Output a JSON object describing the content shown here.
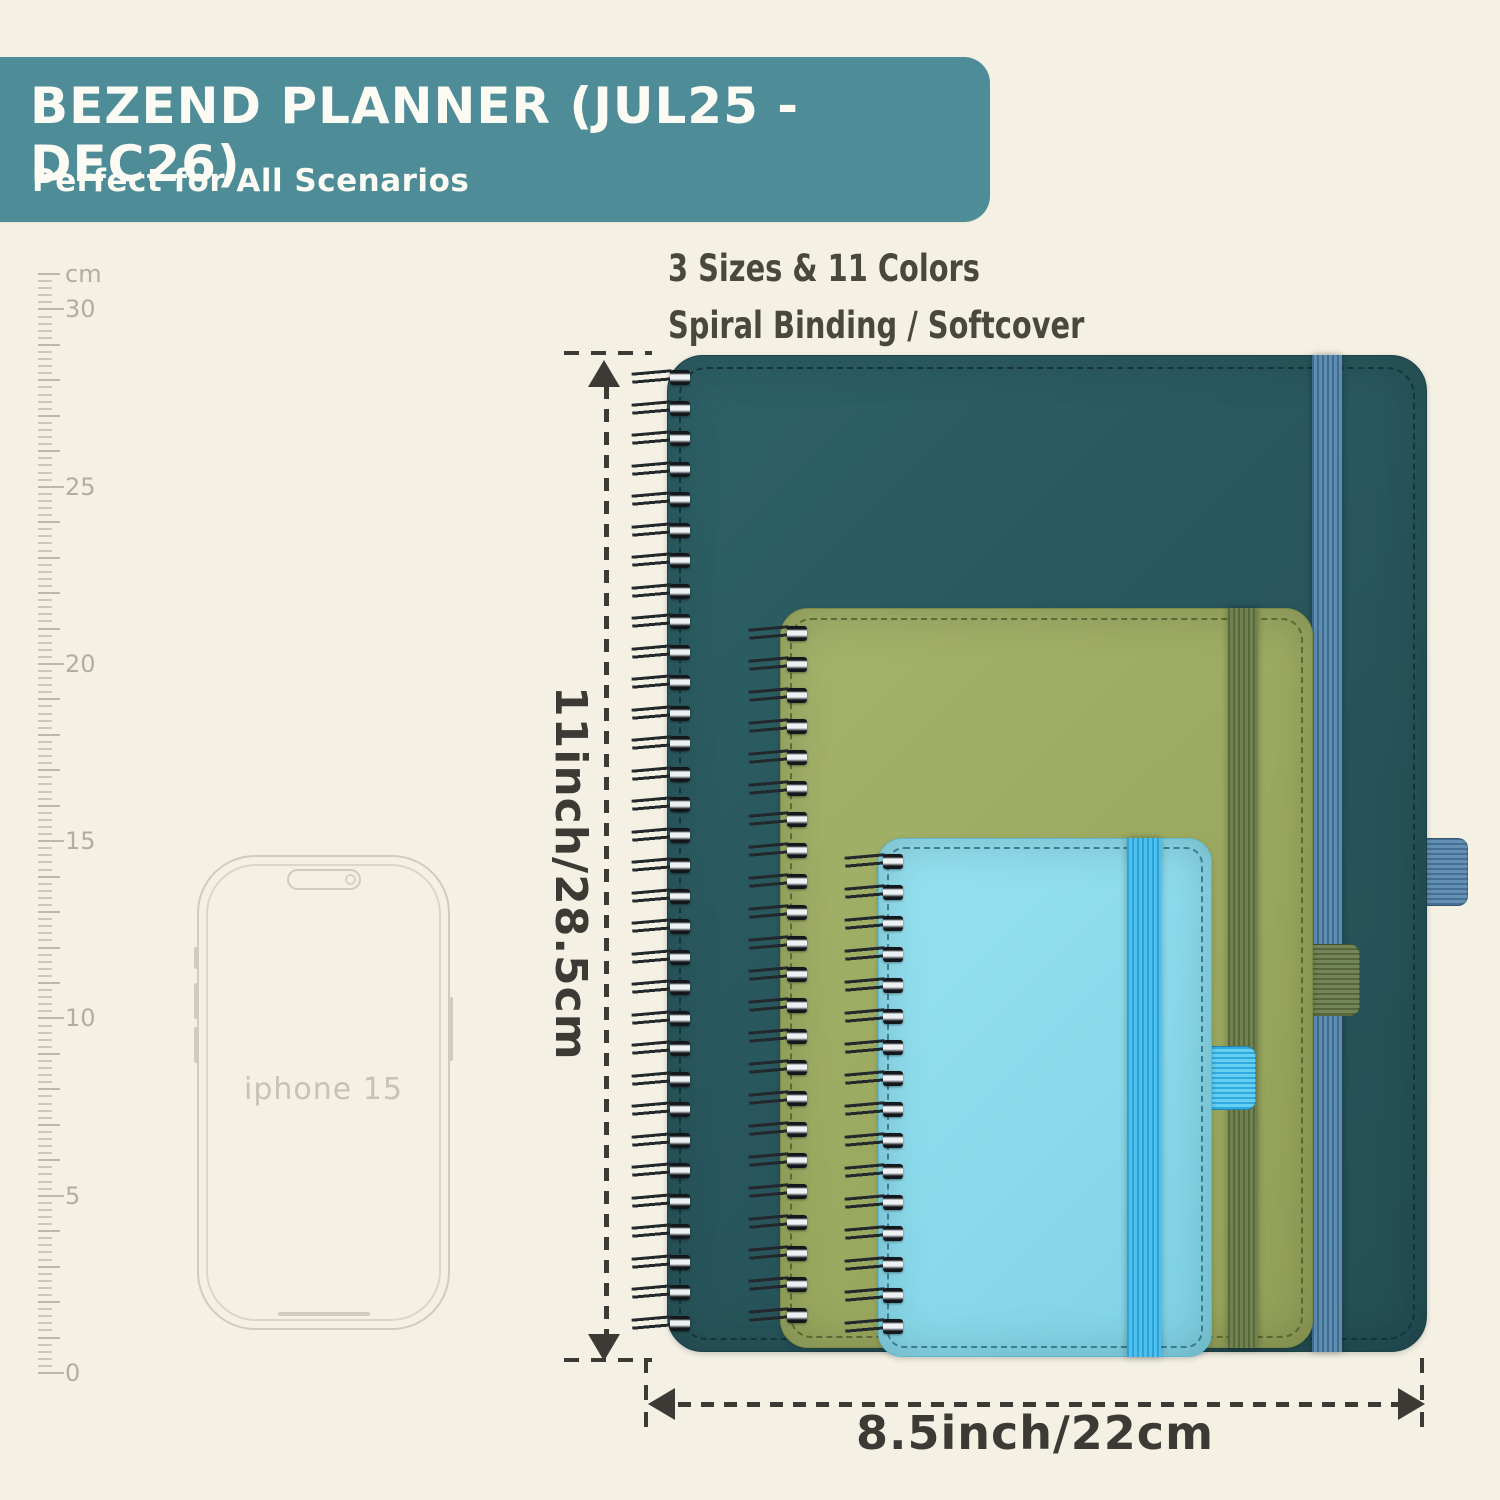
{
  "banner": {
    "title": "BEZEND PLANNER (JUL25 - DEC26)",
    "subtitle": "Perfect for All Scenarios",
    "bg_color": "#4e8d97",
    "text_color": "#fbfaf3"
  },
  "features": {
    "line1": "3 Sizes & 11 Colors",
    "line2": "Spiral Binding / Softcover"
  },
  "ruler": {
    "unit": "cm",
    "major_labels": [
      "30",
      "25",
      "20",
      "15",
      "10",
      "5",
      "0"
    ],
    "max_cm": 31,
    "tick_color": "#bdb9aa"
  },
  "phone": {
    "label": "iphone 15"
  },
  "planners": [
    {
      "name": "large-planner",
      "year_label": "2025-26",
      "cover_color": "#27555b",
      "band_color": "#5d8db1",
      "emboss_color": "#1e4950",
      "coil_count": 32
    },
    {
      "name": "medium-planner",
      "year_label": "2025-26",
      "cover_color": "#9aa85f",
      "band_color": "#72824f",
      "emboss_color": "#6f7c38",
      "coil_count": 23
    },
    {
      "name": "small-planner",
      "year_label": "2025-26",
      "cover_color": "#88d9ea",
      "band_color": "#4fc0ec",
      "emboss_color": "#55b2c6",
      "coil_count": 16
    }
  ],
  "size_annotations": {
    "height_label": "11inch/28.5cm",
    "width_label": "8.5inch/22cm",
    "line_color": "#3b3a35"
  },
  "page_bg_color": "#f4f1e4"
}
